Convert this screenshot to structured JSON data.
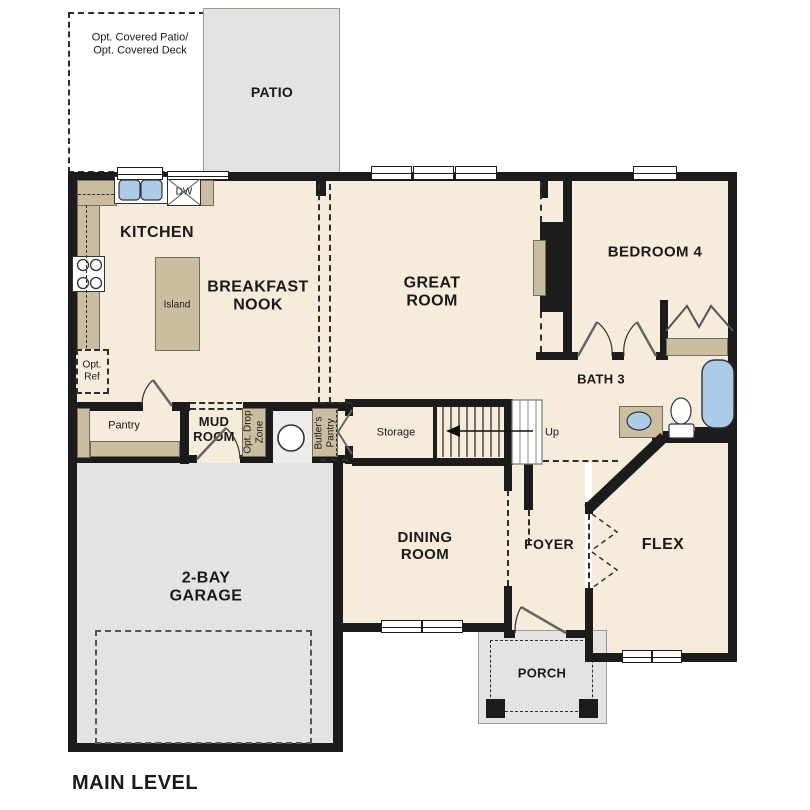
{
  "title": "MAIN LEVEL",
  "colors": {
    "wall": "#1c1c1c",
    "floor_cream": "#f5ecdc",
    "cabinet_tan": "#cbbda0",
    "concrete_gray": "#e4e3e1",
    "fixture_blue": "#abcbe8"
  },
  "rooms": {
    "patio": "PATIO",
    "kitchen": "KITCHEN",
    "breakfast_nook": "BREAKFAST\nNOOK",
    "great_room": "GREAT\nROOM",
    "bedroom4": "BEDROOM 4",
    "bath3": "BATH 3",
    "mud_room": "MUD\nROOM",
    "pantry": "Pantry",
    "storage": "Storage",
    "dining_room": "DINING\nROOM",
    "foyer": "FOYER",
    "flex": "FLEX",
    "garage": "2-BAY\nGARAGE",
    "porch": "PORCH"
  },
  "annotations": {
    "opt_covered": "Opt. Covered Patio/\nOpt. Covered Deck",
    "opt_ref": "Opt.\nRef",
    "island": "Island",
    "dw": "DW",
    "wh": "WH",
    "up": "Up",
    "opt_drop_zone": "Opt. Drop\nZone",
    "butlers_pantry": "Butler's\nPantry"
  }
}
